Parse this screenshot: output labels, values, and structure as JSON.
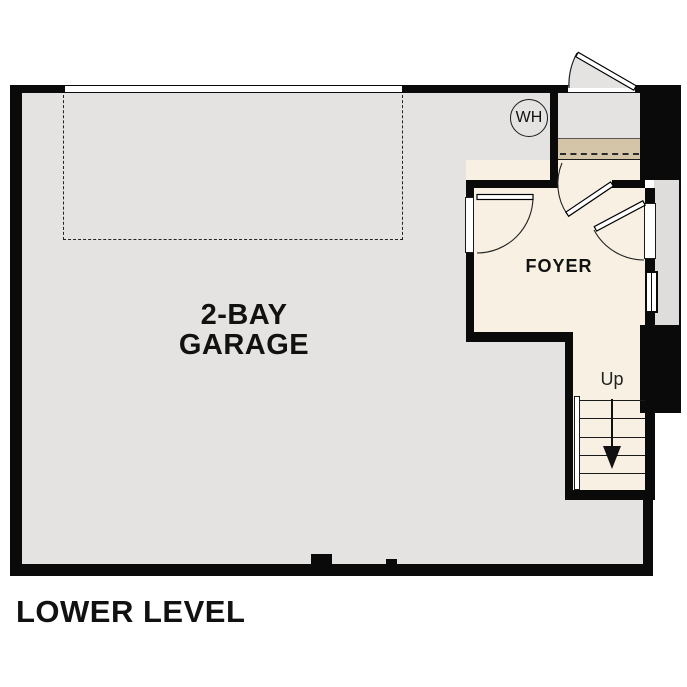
{
  "title": "LOWER LEVEL",
  "rooms": {
    "garage": {
      "name_line1": "2-BAY",
      "name_line2": "GARAGE"
    },
    "foyer": {
      "name": "FOYER"
    },
    "stairs": {
      "direction_label": "Up"
    }
  },
  "fixtures": {
    "water_heater": {
      "label": "WH"
    }
  },
  "colors": {
    "wall": "#0a0a0a",
    "garage": "#e4e3e1",
    "foyer": "#f8f1e3",
    "tan": "#d4c5a9",
    "stoop": "#dedddc",
    "line": "#1a1a1a",
    "text": "#111111"
  }
}
